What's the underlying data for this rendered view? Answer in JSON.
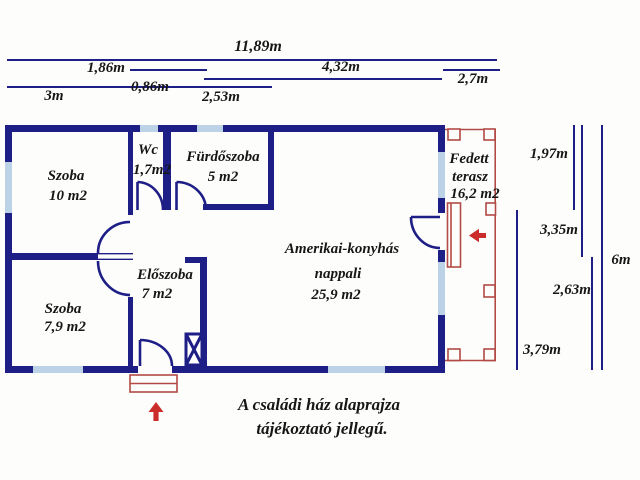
{
  "note": {
    "lines": [
      "A családi ház alaprajza",
      "tájékoztató jellegű."
    ]
  },
  "rooms": [
    {
      "id": "szoba-1",
      "lines": [
        "Szoba",
        "10 m2"
      ]
    },
    {
      "id": "wc",
      "lines": [
        "Wc",
        "1,7m2"
      ]
    },
    {
      "id": "furdoszoba",
      "lines": [
        "Fürdőszoba",
        "5 m2"
      ]
    },
    {
      "id": "fedett-terasz",
      "lines": [
        "Fedett",
        "terasz",
        "16,2 m2"
      ]
    },
    {
      "id": "nappali",
      "lines": [
        "Amerikai-konyhás",
        "nappali",
        "25,9 m2"
      ]
    },
    {
      "id": "eloszoba",
      "lines": [
        "Előszoba",
        "7 m2"
      ]
    },
    {
      "id": "szoba-2",
      "lines": [
        "Szoba",
        "7,9 m2"
      ]
    }
  ],
  "dimensions": {
    "top": [
      "11,89m",
      "1,86m",
      "4,32m",
      "2,7m",
      "0,86m",
      "3m",
      "2,53m"
    ],
    "right": [
      "1,97m",
      "3,35m",
      "6m",
      "2,63m",
      "3,79m"
    ]
  },
  "symbols": {
    "entrance_arrow": "arrow-up",
    "terrace_arrow": "arrow-left",
    "chimney": "crossed-box",
    "windows": "light-blue-wall-segments"
  },
  "colors": {
    "wall": "#1e1e87",
    "window": "#bcd2e6",
    "terrace_outline": "#b24b45",
    "arrow": "#cb2d2a",
    "text": "#161616"
  }
}
